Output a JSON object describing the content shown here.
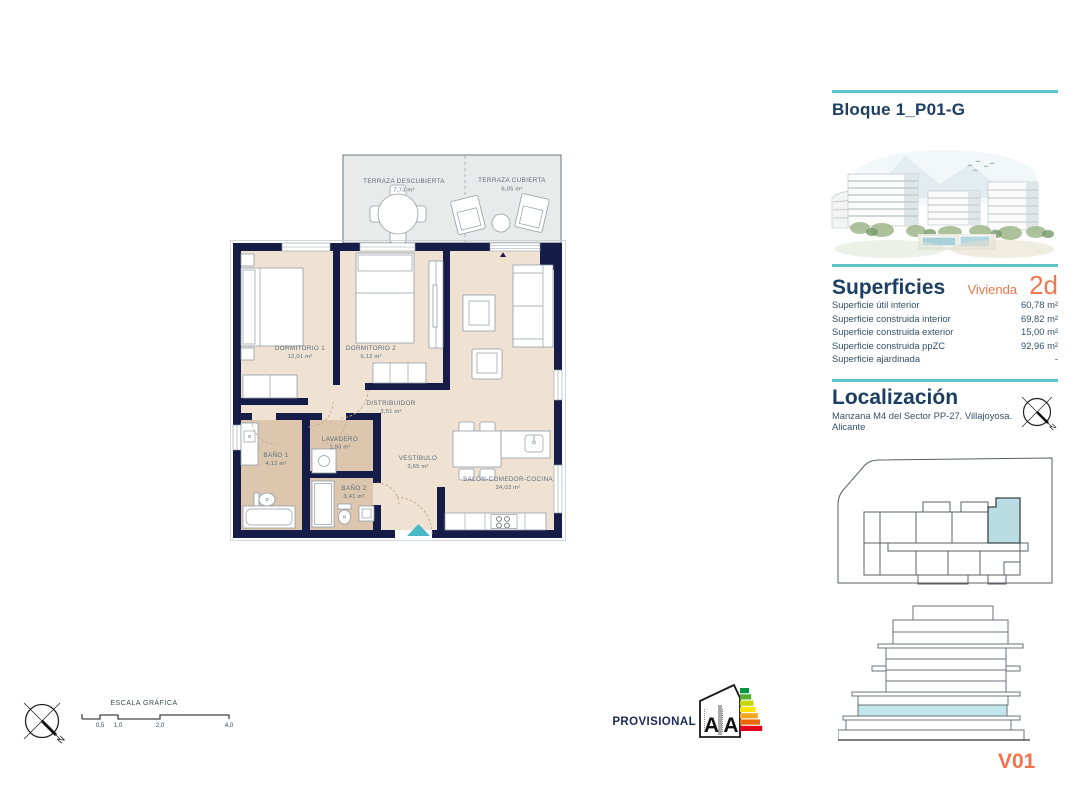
{
  "header": {
    "block_title": "Bloque 1_P01-G"
  },
  "superficies": {
    "title": "Superficies",
    "vivienda_label": "Vivienda",
    "vivienda_code": "2d",
    "rows": [
      {
        "label": "Superficie útil interior",
        "value": "60,78 m²"
      },
      {
        "label": "Superficie construida interior",
        "value": "69,82 m²"
      },
      {
        "label": "Superficie construida exterior",
        "value": "15,00 m²"
      },
      {
        "label": "Superficie construida ppZC",
        "value": "92,96 m²"
      },
      {
        "label": "Superficie ajardinada",
        "value": "-"
      }
    ]
  },
  "localizacion": {
    "title": "Localización",
    "address": "Manzana M4 del Sector PP-27. Villajoyosa. Alicante"
  },
  "plan": {
    "rooms": [
      {
        "name": "TERRAZA DESCUBIERTA",
        "area": "7,73 m²"
      },
      {
        "name": "TERRAZA CUBIERTA",
        "area": "6,05 m²"
      },
      {
        "name": "DORMITORIO 1",
        "area": "12,01 m²"
      },
      {
        "name": "DORMITORIO 2",
        "area": "9,12 m²"
      },
      {
        "name": "DISTRIBUIDOR",
        "area": "2,51 m²"
      },
      {
        "name": "LAVADERO",
        "area": "1,93 m²"
      },
      {
        "name": "BAÑO 1",
        "area": "4,12 m²"
      },
      {
        "name": "BAÑO 2",
        "area": "3,41 m²"
      },
      {
        "name": "VESTÍBULO",
        "area": "3,65 m²"
      },
      {
        "name": "SALÓN-COMEDOR-COCINA",
        "area": "24,03 m²"
      }
    ]
  },
  "scale_bar": {
    "title": "ESCALA GRÁFICA",
    "ticks": [
      "0,5",
      "1,0",
      "2,0",
      "4,0"
    ]
  },
  "compass": {
    "north_label": "N"
  },
  "footer": {
    "provisional_label": "PROVISIONAL",
    "energy_letters": [
      "A",
      "A"
    ],
    "version_code": "V01"
  },
  "colors": {
    "accent_teal": "#5fc3c6",
    "heading_navy": "#1c3e63",
    "accent_orange": "#f0764e",
    "wall_navy": "#151c47",
    "floor_beige": "#efe2d2",
    "bath_tan": "#dcc7ae",
    "terrace_gray": "#e9ebea",
    "unit_highlight": "#b9dde2",
    "entry_arrow": "#49b8c6",
    "energy_scale": [
      "#00963f",
      "#52ae32",
      "#c8d400",
      "#fce300",
      "#f5a623",
      "#ec6607",
      "#e2001a"
    ]
  }
}
